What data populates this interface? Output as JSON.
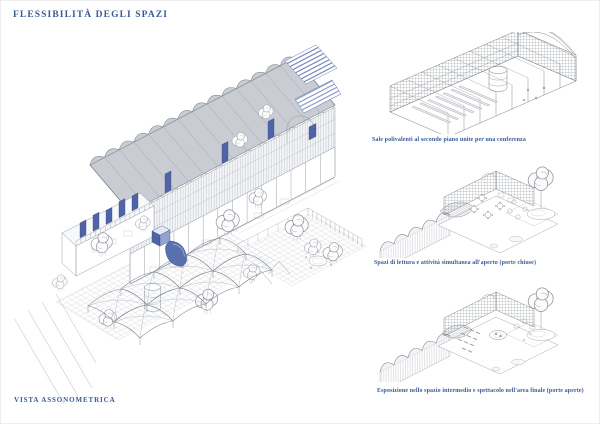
{
  "board": {
    "title": "FLESSIBILITÀ DEGLI SPAZI",
    "main_figure": {
      "label": "VISTA ASSONOMETRICA"
    },
    "side_figures": [
      {
        "caption": "Sale polivalenti al secondo piano unite per una conferenza"
      },
      {
        "caption": "Spazi di lettura e attività simultanea all'aperto (porte chiuse)"
      },
      {
        "caption": "Esposizione nello spazio intermedio e spettacolo nell'area finale (porte aperte)"
      }
    ]
  },
  "icons": {
    "main_drawing": "axonometric-building-drawing",
    "side_drawings": [
      "conference-hall-drawing",
      "courtyard-closed-doors-drawing",
      "courtyard-open-doors-drawing"
    ]
  },
  "colors": {
    "text_blue": "#3a5a96",
    "accent_blue": "#4e63a8",
    "accent_blue_light": "#8fa0cd",
    "line_grey": "#8a9099",
    "roof_grey": "#c9cdd3",
    "hatch_grey": "#dadce1",
    "paper": "#ffffff"
  }
}
